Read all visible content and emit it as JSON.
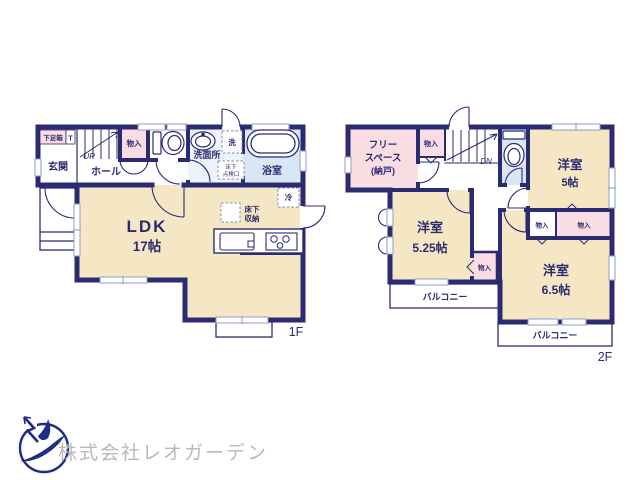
{
  "colors": {
    "wall_navy": "#2b2b72",
    "room_cream": "#f6e7c4",
    "room_pink": "#fadde2",
    "bath_blue": "#d9e7f4",
    "washroom_blue": "#edf3fb",
    "window_gray": "#8c9cc4",
    "logo_blue": "#1f2c87",
    "company_text_gray": "#b9b9b9"
  },
  "company": {
    "name": "株式会社レオガーデン",
    "logo": "bird-in-circle"
  },
  "floor1": {
    "floor_label": "1F",
    "entrance": "玄関",
    "shoe_box": "下足箱",
    "shoe_box_tag": "T",
    "stairs_up": "UP",
    "hall": "ホール",
    "closet": "物入",
    "washroom": "洗面所",
    "washer": "洗",
    "underfloor_hatch_line1": "床下",
    "underfloor_hatch_line2": "点検口",
    "bathroom": "浴室",
    "ldk_name": "LDK",
    "ldk_size": "17帖",
    "fridge": "冷",
    "underfloor_storage_line1": "床下",
    "underfloor_storage_line2": "収納"
  },
  "floor2": {
    "floor_label": "2F",
    "free_space_line1": "フリー",
    "free_space_line2": "スペース",
    "free_space_line3": "(納戸)",
    "closet": "物入",
    "stairs_down": "DN",
    "room_5_name": "洋室",
    "room_5_size": "5帖",
    "room_525_name": "洋室",
    "room_525_size": "5.25帖",
    "room_65_name": "洋室",
    "room_65_size": "6.5帖",
    "balcony": "バルコニー"
  }
}
